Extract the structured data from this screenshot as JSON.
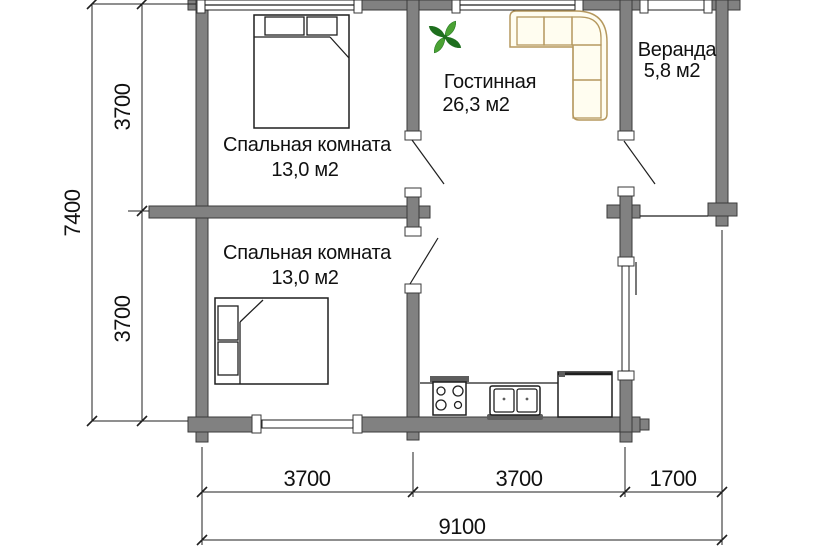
{
  "plan": {
    "rooms": {
      "bedroom1": {
        "label": "Спальная комната",
        "area": "13,0 м2"
      },
      "bedroom2": {
        "label": "Спальная комната",
        "area": "13,0 м2"
      },
      "living": {
        "label": "Гостинная",
        "area": "26,3 м2"
      },
      "veranda": {
        "label": "Веранда",
        "area": "5,8 м2"
      }
    },
    "dimensions": {
      "left_total": "7400",
      "left_upper": "3700",
      "left_lower": "3700",
      "bottom_seg1": "3700",
      "bottom_seg2": "3700",
      "bottom_seg3": "1700",
      "bottom_total": "9100"
    },
    "icons": {
      "plant": "plant-icon",
      "sofa": "corner-sofa-icon",
      "bed_top": "double-bed-icon",
      "bed_bottom": "double-bed-icon",
      "stove": "stove-icon",
      "sink": "double-sink-icon",
      "counter": "kitchen-counter-icon"
    },
    "colors": {
      "bg": "#ffffff",
      "wall_fill": "#818181",
      "wall_stroke": "#3a3a3a",
      "line_color": "#1f1f1f",
      "text_color": "#111111",
      "sofa_stroke": "#b5985e",
      "sofa_fill": "#fffdf0",
      "plant_dark": "#1e6f1e",
      "plant_light": "#4aa233",
      "fixture_dark": "#5d5d5d"
    }
  }
}
